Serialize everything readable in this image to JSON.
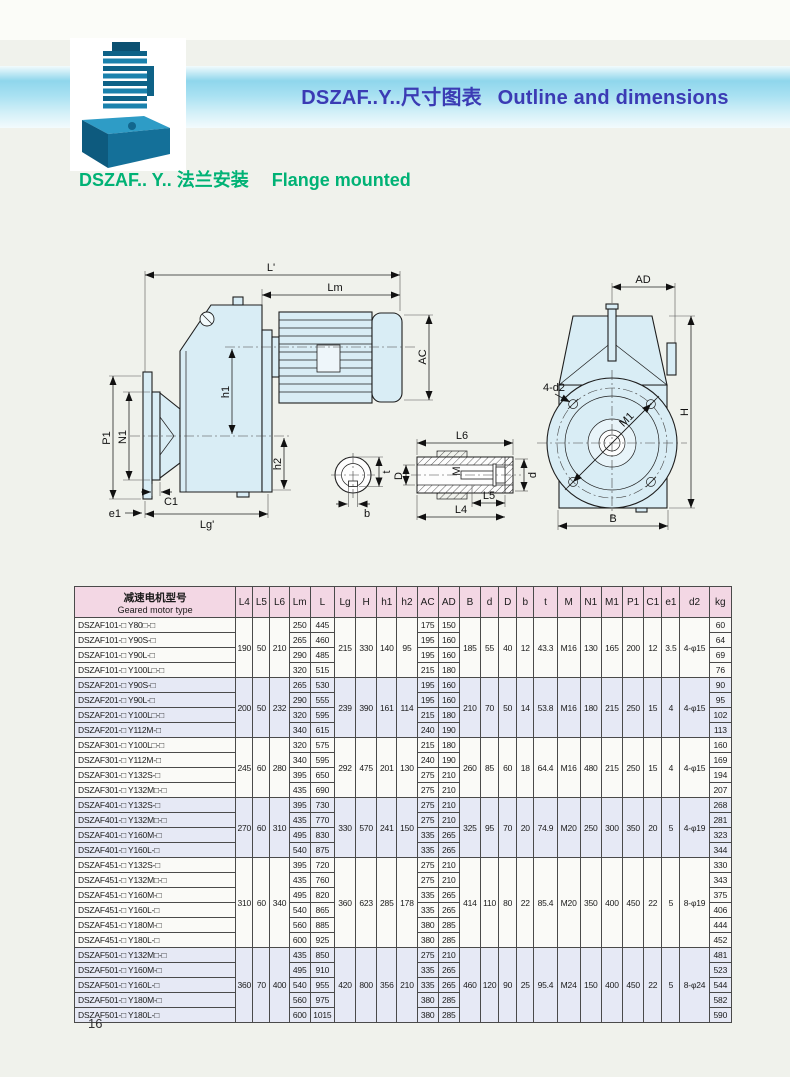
{
  "page": {
    "number": "16"
  },
  "header": {
    "title_zh": "DSZAF..Y..尺寸图表",
    "title_en": "Outline and dimensions",
    "subtitle_zh": "DSZAF.. Y.. 法兰安装",
    "subtitle_en": "Flange mounted"
  },
  "colors": {
    "title_blue": "#3b3bb4",
    "subtitle_green": "#00b275",
    "band_cyan": "#8fd6ec",
    "table_header_pink": "#f3d7e4",
    "group_tint_lavender": "#e6e9f5",
    "drawing_fill_cyan": "#d9edf5"
  },
  "drawing": {
    "labels": {
      "L_prime": "L'",
      "Lm": "Lm",
      "AC": "AC",
      "h1": "h1",
      "h2": "h2",
      "P1": "P1",
      "N1": "N1",
      "e1": "e1",
      "C1": "C1",
      "Lg_prime": "Lg'",
      "t": "t",
      "b": "b",
      "L6": "L6",
      "D": "D",
      "M": "M",
      "d": "d",
      "L5": "L5",
      "L4": "L4",
      "AD": "AD",
      "H": "H",
      "B": "B",
      "d2": "4-d2",
      "M1": "M1"
    }
  },
  "table": {
    "header_zh": "减速电机型号",
    "header_en": "Geared motor type",
    "columns": [
      "L4",
      "L5",
      "L6",
      "Lm",
      "L",
      "Lg",
      "H",
      "h1",
      "h2",
      "AC",
      "AD",
      "B",
      "d",
      "D",
      "b",
      "t",
      "M",
      "N1",
      "M1",
      "P1",
      "C1",
      "e1",
      "d2",
      "kg"
    ],
    "groups": [
      {
        "shared": {
          "L4": "190",
          "L5": "50",
          "L6": "210",
          "Lg": "215",
          "H": "330",
          "h1": "140",
          "h2": "95",
          "B": "185",
          "d": "55",
          "D": "40",
          "b": "12",
          "t": "43.3",
          "M": "M16",
          "N1": "130",
          "M1": "165",
          "P1": "200",
          "C1": "12",
          "e1": "3.5",
          "d2": "4-φ15"
        },
        "rows": [
          {
            "model": "DSZAF101-□ Y80□-□",
            "Lm": "250",
            "L": "445",
            "AC": "175",
            "AD": "150",
            "kg": "60"
          },
          {
            "model": "DSZAF101-□ Y90S-□",
            "Lm": "265",
            "L": "460",
            "AC": "195",
            "AD": "160",
            "kg": "64"
          },
          {
            "model": "DSZAF101-□ Y90L-□",
            "Lm": "290",
            "L": "485",
            "AC": "195",
            "AD": "160",
            "kg": "69"
          },
          {
            "model": "DSZAF101-□ Y100L□-□",
            "Lm": "320",
            "L": "515",
            "AC": "215",
            "AD": "180",
            "kg": "76"
          }
        ]
      },
      {
        "shared": {
          "L4": "200",
          "L5": "50",
          "L6": "232",
          "Lg": "239",
          "H": "390",
          "h1": "161",
          "h2": "114",
          "B": "210",
          "d": "70",
          "D": "50",
          "b": "14",
          "t": "53.8",
          "M": "M16",
          "N1": "180",
          "M1": "215",
          "P1": "250",
          "C1": "15",
          "e1": "4",
          "d2": "4-φ15"
        },
        "rows": [
          {
            "model": "DSZAF201-□ Y90S-□",
            "Lm": "265",
            "L": "530",
            "AC": "195",
            "AD": "160",
            "kg": "90"
          },
          {
            "model": "DSZAF201-□ Y90L-□",
            "Lm": "290",
            "L": "555",
            "AC": "195",
            "AD": "160",
            "kg": "95"
          },
          {
            "model": "DSZAF201-□ Y100L□-□",
            "Lm": "320",
            "L": "595",
            "AC": "215",
            "AD": "180",
            "kg": "102"
          },
          {
            "model": "DSZAF201-□ Y112M-□",
            "Lm": "340",
            "L": "615",
            "AC": "240",
            "AD": "190",
            "kg": "113"
          }
        ]
      },
      {
        "shared": {
          "L4": "245",
          "L5": "60",
          "L6": "280",
          "Lg": "292",
          "H": "475",
          "h1": "201",
          "h2": "130",
          "B": "260",
          "d": "85",
          "D": "60",
          "b": "18",
          "t": "64.4",
          "M": "M16",
          "N1": "480",
          "M1": "215",
          "P1": "250",
          "C1": "15",
          "e1": "4",
          "d2": "4-φ15"
        },
        "rows": [
          {
            "model": "DSZAF301-□ Y100L□-□",
            "Lm": "320",
            "L": "575",
            "AC": "215",
            "AD": "180",
            "kg": "160"
          },
          {
            "model": "DSZAF301-□ Y112M-□",
            "Lm": "340",
            "L": "595",
            "AC": "240",
            "AD": "190",
            "kg": "169"
          },
          {
            "model": "DSZAF301-□ Y132S-□",
            "Lm": "395",
            "L": "650",
            "AC": "275",
            "AD": "210",
            "kg": "194"
          },
          {
            "model": "DSZAF301-□ Y132M□-□",
            "Lm": "435",
            "L": "690",
            "AC": "275",
            "AD": "210",
            "kg": "207"
          }
        ]
      },
      {
        "shared": {
          "L4": "270",
          "L5": "60",
          "L6": "310",
          "Lg": "330",
          "H": "570",
          "h1": "241",
          "h2": "150",
          "B": "325",
          "d": "95",
          "D": "70",
          "b": "20",
          "t": "74.9",
          "M": "M20",
          "N1": "250",
          "M1": "300",
          "P1": "350",
          "C1": "20",
          "e1": "5",
          "d2": "4-φ19"
        },
        "rows": [
          {
            "model": "DSZAF401-□ Y132S-□",
            "Lm": "395",
            "L": "730",
            "AC": "275",
            "AD": "210",
            "kg": "268"
          },
          {
            "model": "DSZAF401-□ Y132M□-□",
            "Lm": "435",
            "L": "770",
            "AC": "275",
            "AD": "210",
            "kg": "281"
          },
          {
            "model": "DSZAF401-□ Y160M-□",
            "Lm": "495",
            "L": "830",
            "AC": "335",
            "AD": "265",
            "kg": "323"
          },
          {
            "model": "DSZAF401-□ Y160L-□",
            "Lm": "540",
            "L": "875",
            "AC": "335",
            "AD": "265",
            "kg": "344"
          }
        ]
      },
      {
        "shared": {
          "L4": "310",
          "L5": "60",
          "L6": "340",
          "Lg": "360",
          "H": "623",
          "h1": "285",
          "h2": "178",
          "B": "414",
          "d": "110",
          "D": "80",
          "b": "22",
          "t": "85.4",
          "M": "M20",
          "N1": "350",
          "M1": "400",
          "P1": "450",
          "C1": "22",
          "e1": "5",
          "d2": "8-φ19"
        },
        "rows": [
          {
            "model": "DSZAF451-□ Y132S-□",
            "Lm": "395",
            "L": "720",
            "AC": "275",
            "AD": "210",
            "kg": "330"
          },
          {
            "model": "DSZAF451-□ Y132M□-□",
            "Lm": "435",
            "L": "760",
            "AC": "275",
            "AD": "210",
            "kg": "343"
          },
          {
            "model": "DSZAF451-□ Y160M-□",
            "Lm": "495",
            "L": "820",
            "AC": "335",
            "AD": "265",
            "kg": "375"
          },
          {
            "model": "DSZAF451-□ Y160L-□",
            "Lm": "540",
            "L": "865",
            "AC": "335",
            "AD": "265",
            "kg": "406"
          },
          {
            "model": "DSZAF451-□ Y180M-□",
            "Lm": "560",
            "L": "885",
            "AC": "380",
            "AD": "285",
            "kg": "444"
          },
          {
            "model": "DSZAF451-□ Y180L-□",
            "Lm": "600",
            "L": "925",
            "AC": "380",
            "AD": "285",
            "kg": "452"
          }
        ]
      },
      {
        "shared": {
          "L4": "360",
          "L5": "70",
          "L6": "400",
          "Lg": "420",
          "H": "800",
          "h1": "356",
          "h2": "210",
          "B": "460",
          "d": "120",
          "D": "90",
          "b": "25",
          "t": "95.4",
          "M": "M24",
          "N1": "150",
          "M1": "400",
          "P1": "450",
          "C1": "22",
          "e1": "5",
          "d2": "8-φ24"
        },
        "rows": [
          {
            "model": "DSZAF501-□ Y132M□-□",
            "Lm": "435",
            "L": "850",
            "AC": "275",
            "AD": "210",
            "kg": "481"
          },
          {
            "model": "DSZAF501-□ Y160M-□",
            "Lm": "495",
            "L": "910",
            "AC": "335",
            "AD": "265",
            "kg": "523"
          },
          {
            "model": "DSZAF501-□ Y160L-□",
            "Lm": "540",
            "L": "955",
            "AC": "335",
            "AD": "265",
            "kg": "544"
          },
          {
            "model": "DSZAF501-□ Y180M-□",
            "Lm": "560",
            "L": "975",
            "AC": "380",
            "AD": "285",
            "kg": "582"
          },
          {
            "model": "DSZAF501-□ Y180L-□",
            "Lm": "600",
            "L": "1015",
            "AC": "380",
            "AD": "285",
            "kg": "590"
          }
        ]
      }
    ]
  }
}
